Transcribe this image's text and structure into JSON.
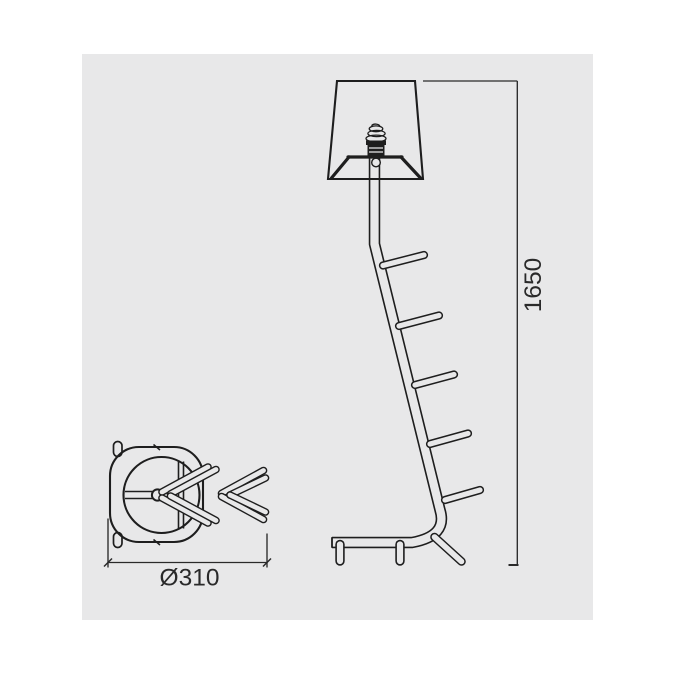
{
  "colors": {
    "page_background": "#ffffff",
    "canvas_background": "#e8e8e9",
    "line_color": "#1e1e1e",
    "dimension_color": "#2a2a2a"
  },
  "drawing": {
    "side_view": {
      "height_label": "1650"
    },
    "top_view": {
      "diameter_label": "Ø310"
    }
  }
}
